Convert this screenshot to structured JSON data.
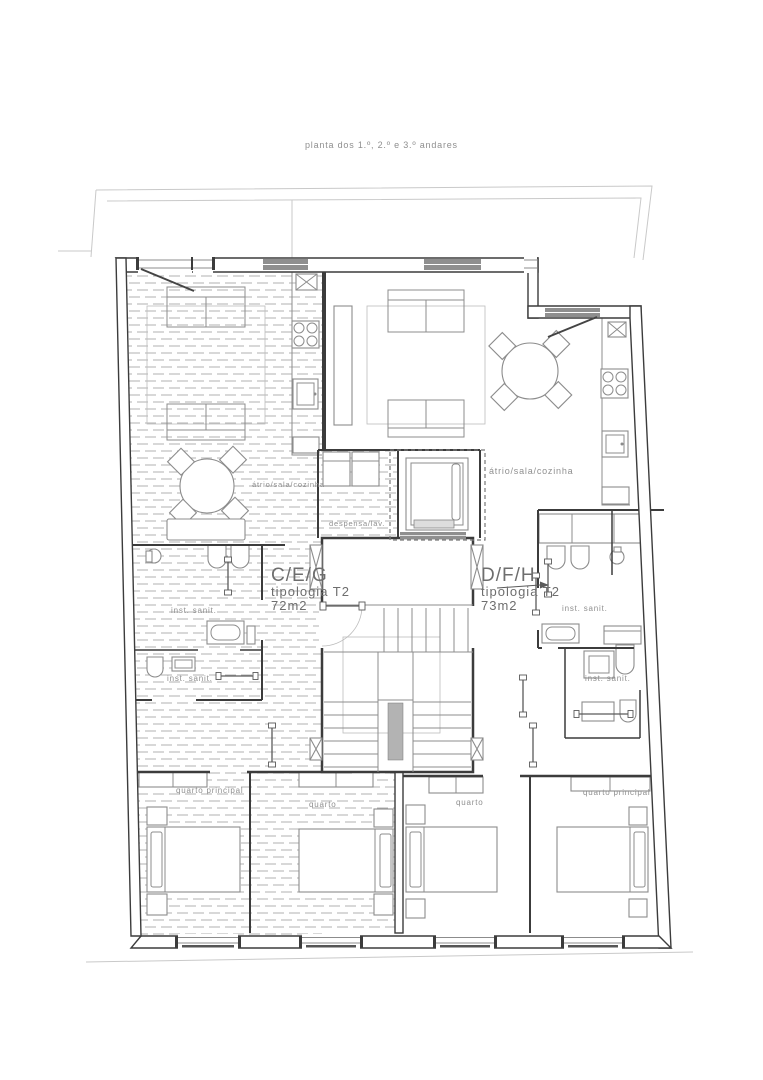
{
  "title": "planta dos 1.º, 2.º e 3.º andares",
  "apartments": {
    "left": {
      "units": "C/E/G",
      "typology": "tipologia T2",
      "area": "72m2"
    },
    "right": {
      "units": "D/F/H",
      "typology": "tipologia T2",
      "area": "73m2"
    }
  },
  "room_labels": {
    "atrio_left": "átrio/sala/cozinha",
    "atrio_right": "átrio/sala/cozinha",
    "despensa": "despensa/lav.",
    "inst_sanit": "inst. sanit.",
    "quarto": "quarto",
    "quarto_principal": "quarto principal"
  },
  "colors": {
    "wall": "#3c3c3c",
    "furniture": "#8c8c8c",
    "hatch": "#b0b0b0",
    "window_fill": "#8f8f8f",
    "boundary": "#c9c9c9",
    "text": "#8f8f8f",
    "stair_shaft": "#b3b3b3"
  }
}
